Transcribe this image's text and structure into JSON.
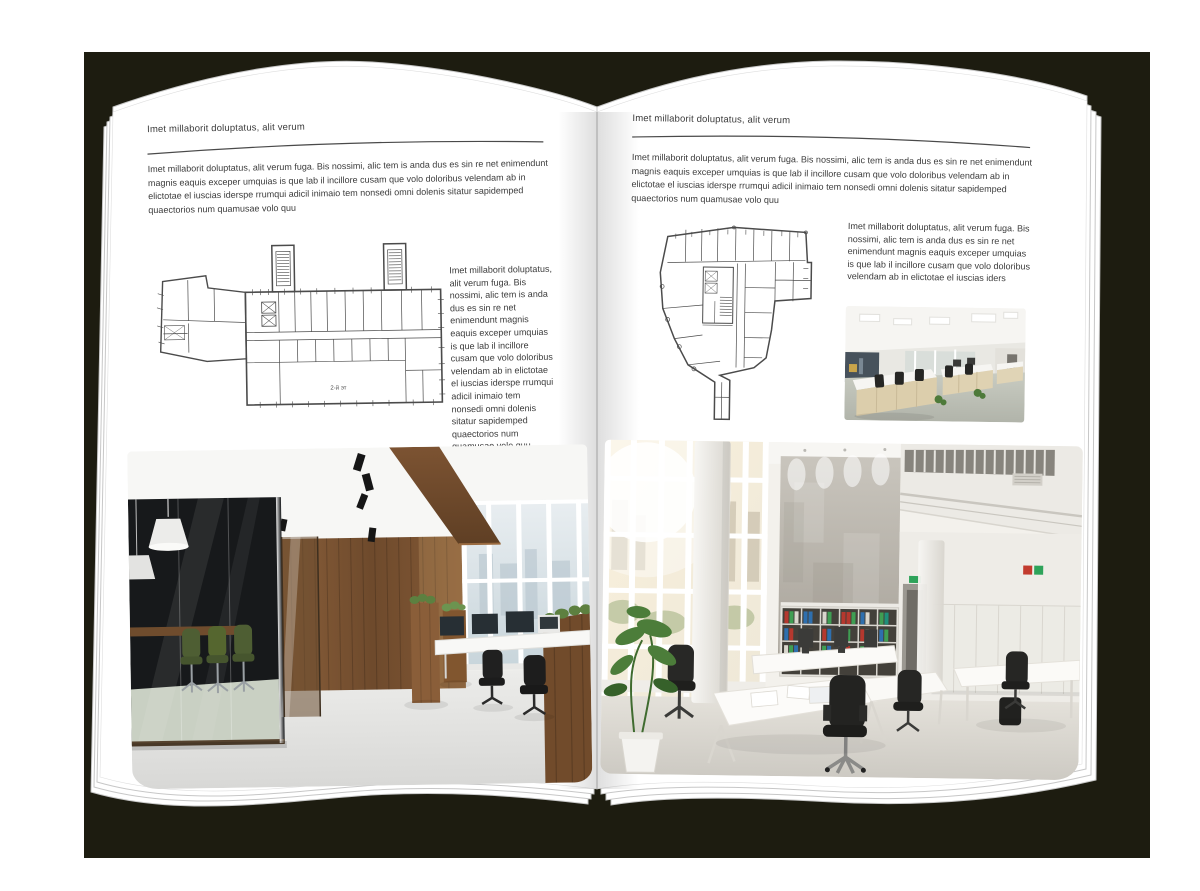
{
  "palette": {
    "canvas": "#ffffff",
    "cover": "#1d1c10",
    "page": "#ffffff",
    "ink": "#3b3b3b",
    "plan-line": "#4b4b4b",
    "wood": "#7d5634",
    "chair-green": "#4e5e33",
    "binder-red": "#b5382e",
    "binder-green": "#3f9e53",
    "binder-blue": "#2e6fae"
  },
  "left_page": {
    "header": "Imet millaborit doluptatus, alit verum",
    "intro": "Imet millaborit doluptatus, alit verum fuga. Bis nossimi, alic tem is anda dus es sin re net enimendunt magnis eaquis exceper umquias is que lab il incillore cusam que volo doloribus velendam ab in elictotae el iuscias iderspe rrumqui adicil inimaio tem nonsedi omni dolenis sitatur sapidemped quaectorios num quamusae volo quu",
    "side_text": "Imet millaborit doluptatus, alit verum fuga. Bis nossimi, alic tem is anda dus es sin re net enimendunt magnis eaquis exceper umquias is que lab il incillore cusam que volo doloribus velendam ab in elictotae el iuscias iderspe rrumqui adicil inimaio tem nonsedi omni dolenis sitatur sapidemped quaectorios num quamusae volo quu",
    "plan_label": "2-й эт"
  },
  "right_page": {
    "header": "Imet millaborit doluptatus, alit verum",
    "intro": "Imet millaborit doluptatus, alit verum fuga. Bis nossimi, alic tem is anda dus es sin re net enimendunt magnis eaquis exceper umquias is que lab il incillore cusam que volo doloribus velendam ab in elictotae el iuscias iderspe rrumqui adicil inimaio tem nonsedi omni dolenis sitatur sapidemped quaectorios num quamusae volo quu",
    "side_text": "Imet millaborit doluptatus, alit verum fuga. Bis nossimi, alic tem is anda dus es sin re net enimendunt magnis eaquis exceper umquias is que lab il incillore cusam que volo doloribus velendam ab in elictotae el iuscias iders"
  }
}
